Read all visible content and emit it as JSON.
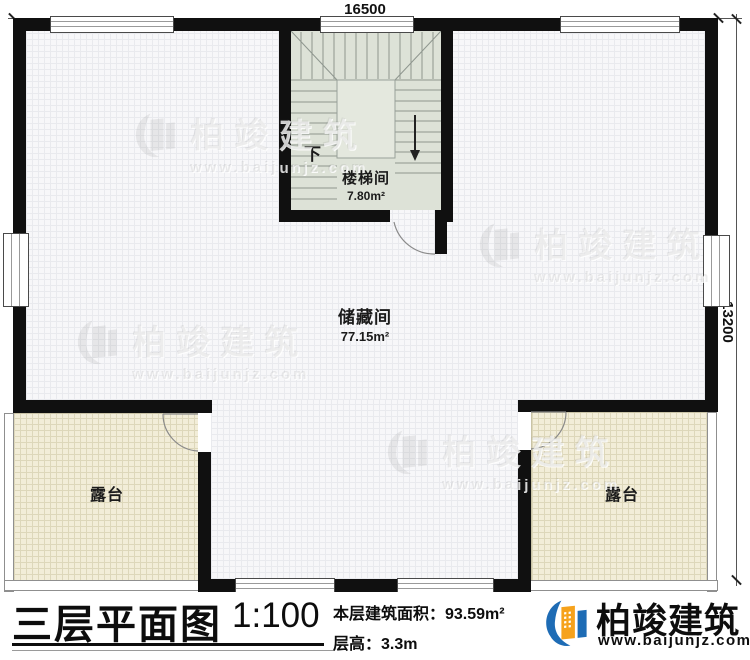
{
  "dimensions": {
    "width_label": "16500",
    "height_label": "13200"
  },
  "rooms": {
    "stairwell": {
      "name": "楼梯间",
      "area": "7.80m²"
    },
    "storage": {
      "name": "储藏间",
      "area": "77.15m²"
    },
    "terrace_left": {
      "name": "露台"
    },
    "terrace_right": {
      "name": "露台"
    },
    "stair_direction": "下"
  },
  "title_block": {
    "title": "三层平面图",
    "scale": "1:100",
    "floor_area": "本层建筑面积：93.59m²",
    "floor_height": "层高：3.3m"
  },
  "brand": {
    "name": "柏竣建筑",
    "url": "www.baijunjz.com"
  },
  "watermark": {
    "name": "柏竣建筑",
    "url": "www.baijunjz.com"
  },
  "colors": {
    "wall": "#101010",
    "terrace_fill": "#f2edd8",
    "stair_fill": "#dde2d7",
    "brand_blue": "#1e6cb5",
    "brand_orange": "#f6a21c"
  }
}
